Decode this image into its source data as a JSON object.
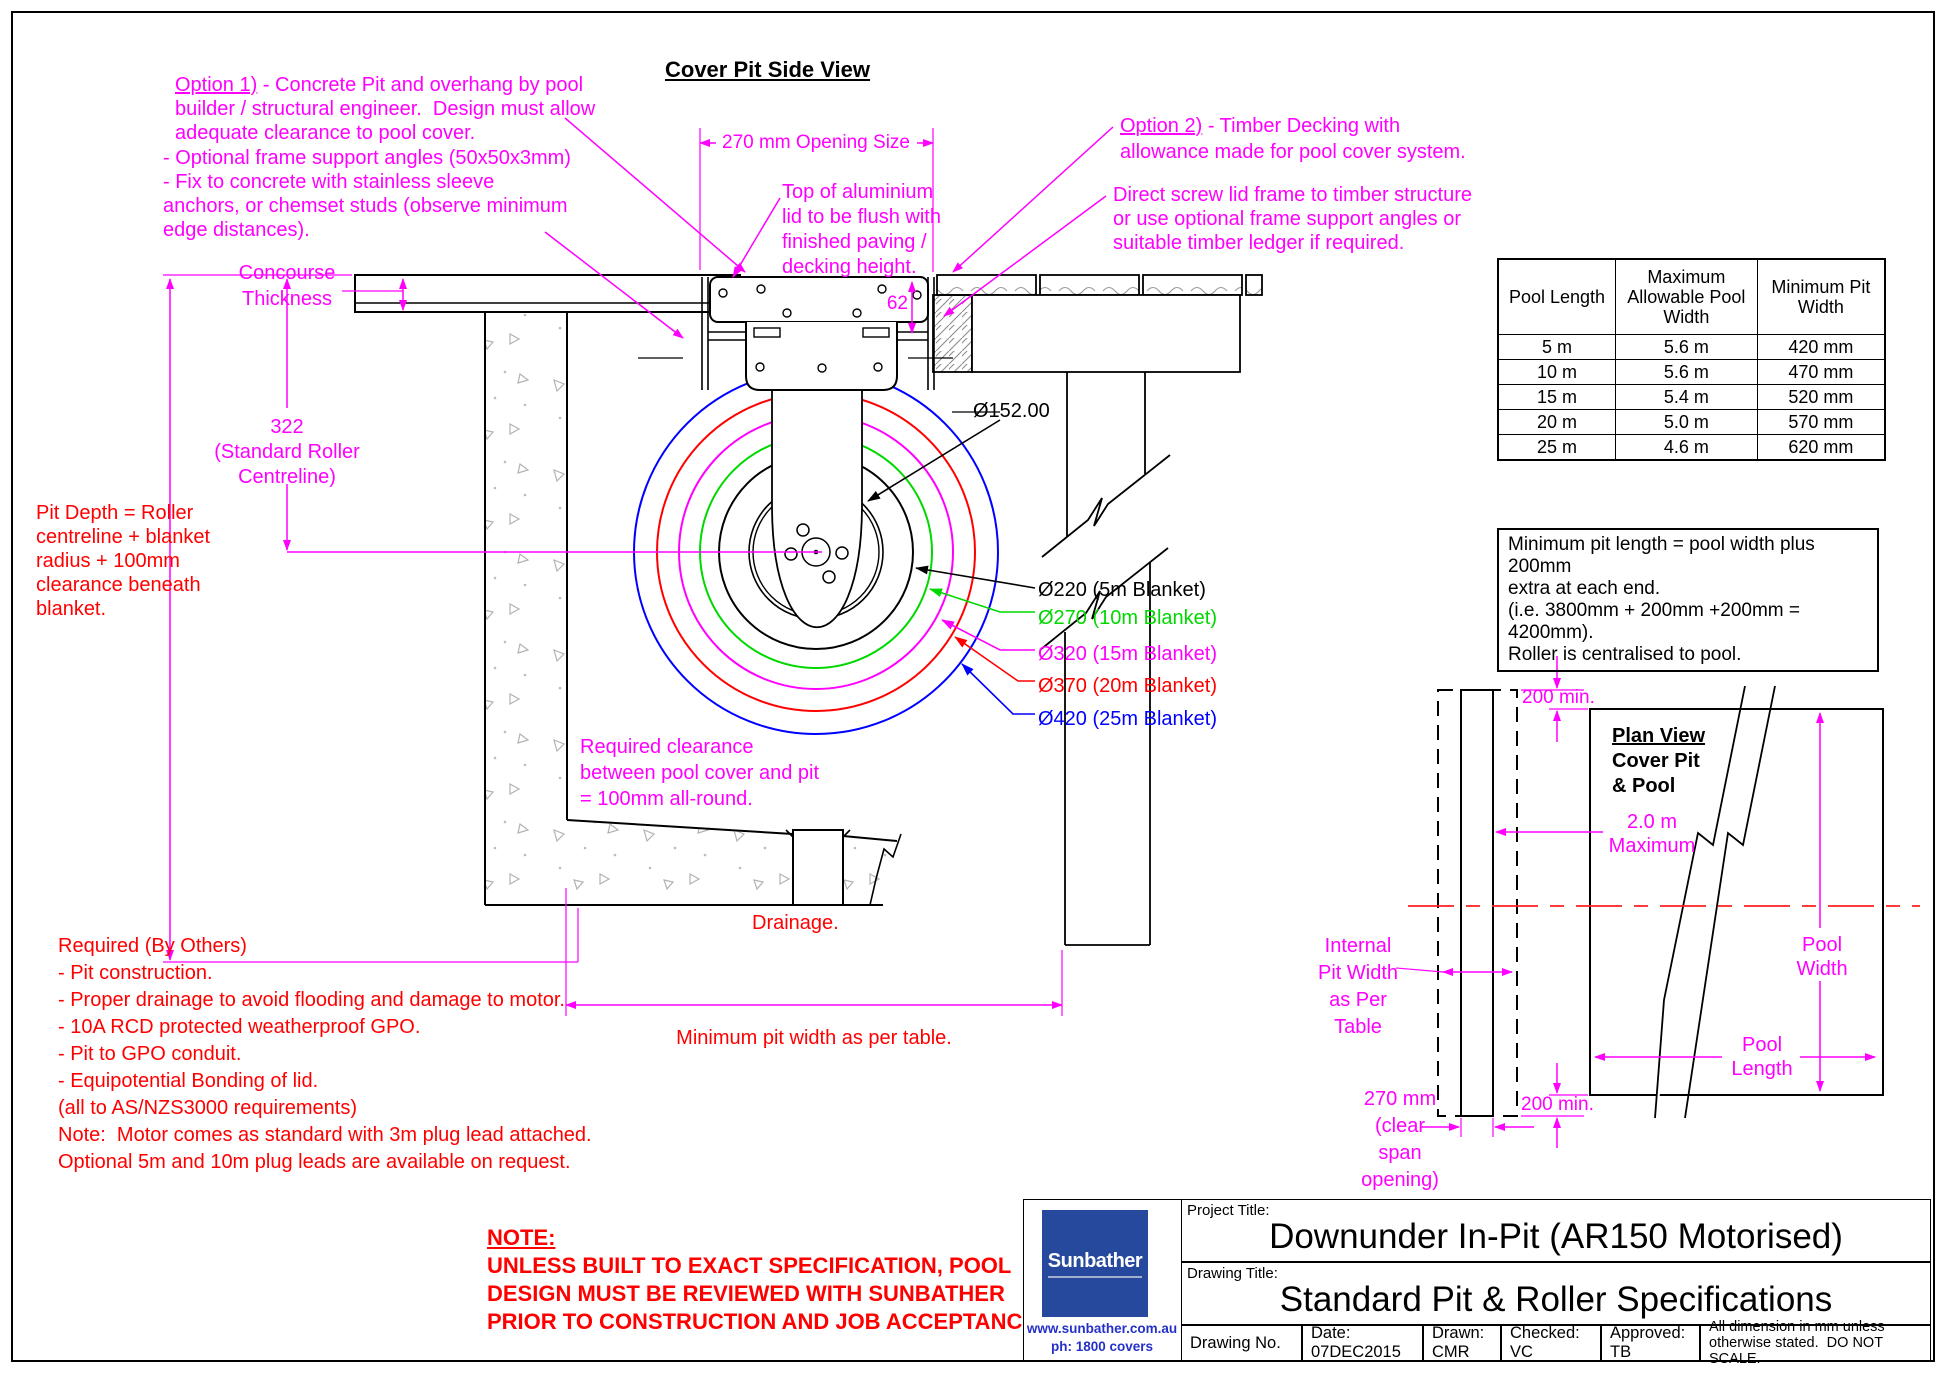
{
  "page": {
    "side_view_title": "Cover Pit Side View"
  },
  "colors": {
    "magenta": "#ff00ff",
    "red": "#ff0000",
    "green": "#00d800",
    "blue": "#0000ff",
    "black": "#000000",
    "logo_blue": "#27499d",
    "link_blue": "#2430c8",
    "centerline_red": "#ff2020"
  },
  "annotations": {
    "option1_head": "Option 1)",
    "option1_rest": " - Concrete Pit and overhang by pool\nbuilder / structural engineer.  Design must allow\nadequate clearance to pool cover.",
    "frame_angles": "- Optional frame support angles (50x50x3mm)\n- Fix to concrete with stainless sleeve\nanchors, or chemset studs (observe minimum\nedge distances).",
    "opening_size": "270 mm Opening Size",
    "top_of_lid": "Top of aluminium\nlid to be flush with\nfinished paving /\ndecking height.",
    "option2_head": "Option 2)",
    "option2_rest": " - Timber Decking with\nallowance made for pool cover system.",
    "direct_screw": "Direct screw lid frame to timber structure\nor use optional frame support angles or\nsuitable timber ledger if required.",
    "dim_62": "62",
    "concourse": "Concourse\nThickness",
    "roller_centreline": "322\n(Standard Roller\nCentreline)",
    "pit_depth": "Pit Depth = Roller\ncentreline + blanket\nradius + 100mm\nclearance beneath\nblanket.",
    "clearance": "Required clearance\nbetween pool cover and pit\n= 100mm all-round.",
    "drainage": "Drainage.",
    "min_pit_width": "Minimum pit width as per table.",
    "dia_roller": "Ø152.00",
    "blanket_labels": [
      {
        "text": "Ø220 (5m Blanket)"
      },
      {
        "text": "Ø270 (10m Blanket)"
      },
      {
        "text": "Ø320 (15m Blanket)"
      },
      {
        "text": "Ø370 (20m Blanket)"
      },
      {
        "text": "Ø420 (25m Blanket)"
      }
    ],
    "required_by_others": "Required (By Others)\n- Pit construction.\n- Proper drainage to avoid flooding and damage to motor.\n- 10A RCD protected weatherproof GPO.\n- Pit to GPO conduit.\n- Equipotential Bonding of lid.\n(all to AS/NZS3000 requirements)",
    "motor_note": "Note:  Motor comes as standard with 3m plug lead attached.\nOptional 5m and 10m plug leads are available on request.",
    "note_head": "NOTE:",
    "note_body": "UNLESS BUILT TO EXACT SPECIFICATION, POOL\nDESIGN MUST BE REVIEWED WITH SUNBATHER\nPRIOR TO CONSTRUCTION AND JOB ACCEPTANCE"
  },
  "table": {
    "headers": [
      "Pool Length",
      "Maximum\nAllowable Pool\nWidth",
      "Minimum Pit\nWidth"
    ],
    "rows": [
      [
        "5 m",
        "5.6 m",
        "420 mm"
      ],
      [
        "10 m",
        "5.6 m",
        "470 mm"
      ],
      [
        "15 m",
        "5.4 m",
        "520 mm"
      ],
      [
        "20 m",
        "5.0 m",
        "570 mm"
      ],
      [
        "25 m",
        "4.6 m",
        "620 mm"
      ]
    ]
  },
  "pit_length_note": "Minimum pit length = pool width plus 200mm\nextra at each end.\n(i.e. 3800mm + 200mm +200mm = 4200mm).\nRoller is centralised to pool.",
  "plan_view": {
    "title_head": "Plan View",
    "title_rest": "Cover Pit\n& Pool",
    "max_2m": "2.0 m\nMaximum",
    "top_200": "200 min.",
    "bottom_200": "200 min.",
    "pool_width": "Pool\nWidth",
    "pool_length": "Pool\nLength",
    "internal_pit_width": "Internal\nPit Width\nas Per\nTable",
    "clear_span": "270 mm\n(clear\nspan\nopening)"
  },
  "title_block": {
    "logo_text": "Sunbather",
    "logo_url": "www.sunbather.com.au",
    "logo_phone": "ph:  1800 covers",
    "project_label": "Project Title:",
    "project_title": "Downunder In-Pit  (AR150 Motorised)",
    "drawing_label": "Drawing Title:",
    "drawing_title": "Standard Pit & Roller Specifications",
    "drawing_no": "Drawing No.",
    "date": "Date: 07DEC2015",
    "drawn": "Drawn: CMR",
    "checked": "Checked: VC",
    "approved": "Approved: TB",
    "dimension_note": "All dimension in mm unless\notherwise stated.  DO NOT SCALE."
  }
}
